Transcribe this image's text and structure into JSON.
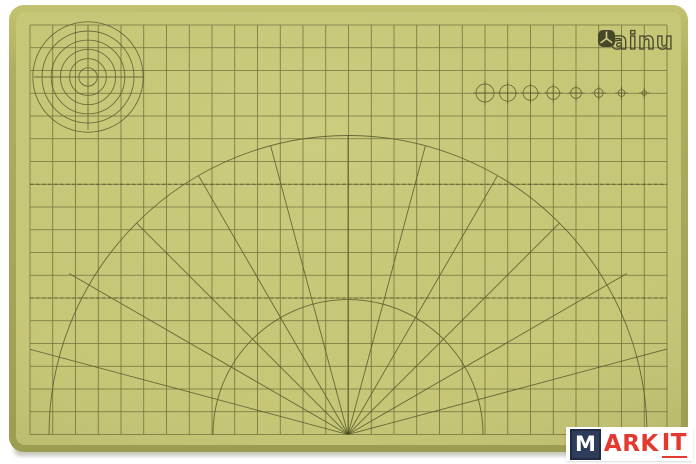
{
  "mat": {
    "brand": {
      "text": "ainu",
      "icon": "cube-icon"
    },
    "colors": {
      "surface": "#c6c777",
      "surface_light": "#d0d185",
      "surface_dark": "#aaab5e",
      "edge": "#9b9d52",
      "edge_light": "#c2c370",
      "line": "#55582c",
      "logo": "#45462a"
    },
    "grid": {
      "x": 30,
      "y": 25,
      "cols": 28,
      "rows": 18,
      "cell": 22.75
    },
    "dashed_rows": [
      7,
      12
    ],
    "fan": {
      "cx": 348,
      "cy": 434.5,
      "outer_radius": 299,
      "inner_radius": 135,
      "angles_deg": [
        15,
        30,
        45,
        60,
        75,
        90,
        105,
        120,
        135,
        150,
        165
      ],
      "long_ray_length": 330,
      "mid_ray_length": 322,
      "ray_length": 299
    },
    "target_circles": {
      "cx": 88,
      "cy": 77,
      "count": 6,
      "radius_step": 9.2,
      "cross_x1": 34,
      "cross_x2": 143,
      "cross_y1": 25,
      "cross_y2": 130
    },
    "circle_row": {
      "y": 93,
      "start_x": 485,
      "spacing": 22.75,
      "radii": [
        9,
        8.2,
        7.4,
        6.4,
        5.4,
        4.4,
        3.4,
        2.4
      ]
    }
  },
  "watermark": {
    "m": "M",
    "ark": "ARK",
    "it": "IT",
    "m_bg": "#2d3c58",
    "text_color": "#e23a2e"
  }
}
